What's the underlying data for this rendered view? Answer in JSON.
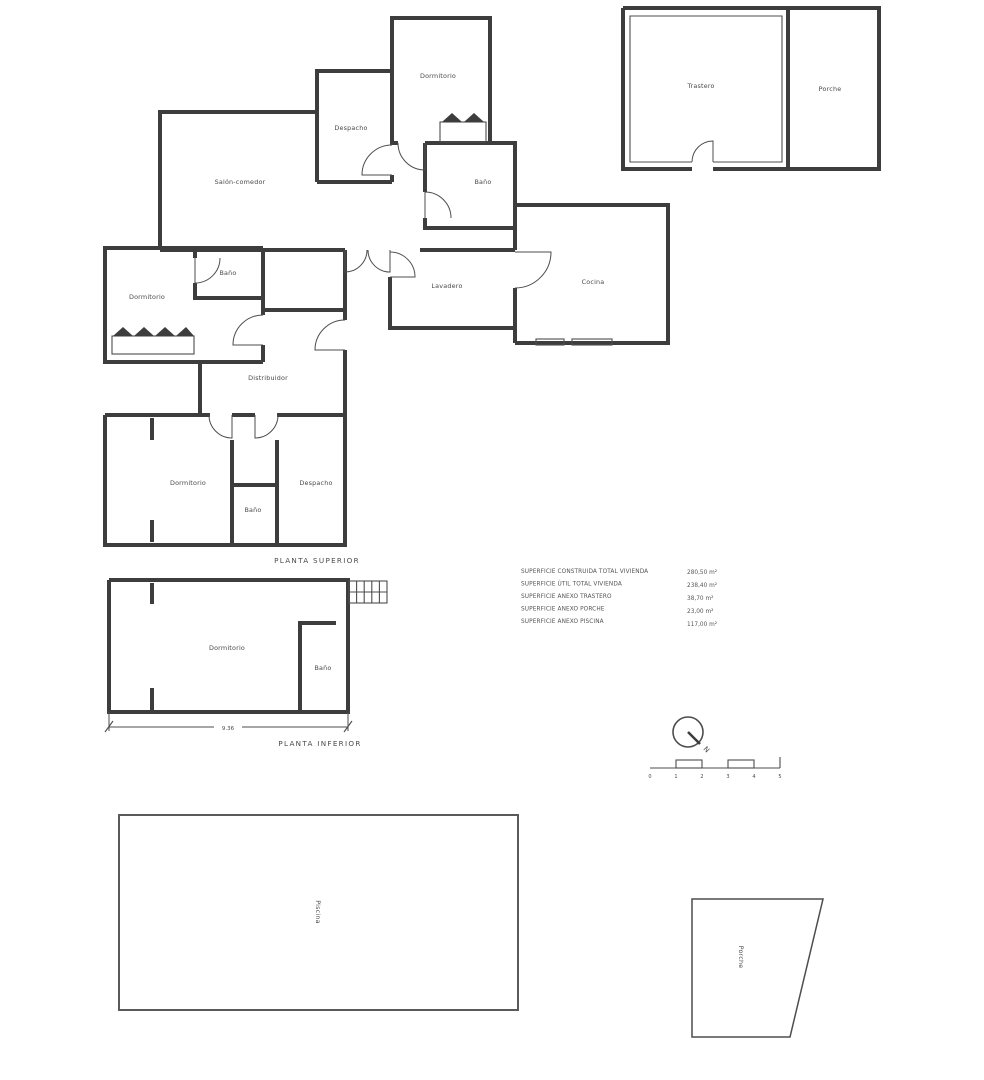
{
  "upper_plan": {
    "title": "PLANTA SUPERIOR",
    "rooms": {
      "dormitorio_top": "Dormitorio",
      "despacho_top": "Despacho",
      "salon_comedor": "Salón-comedor",
      "bano_top": "Baño",
      "cocina": "Cocina",
      "lavadero": "Lavadero",
      "dormitorio_left": "Dormitorio",
      "bano_left": "Baño",
      "distribuidor": "Distribuidor",
      "dormitorio_bottom": "Dormitorio",
      "bano_bottom": "Baño",
      "despacho_bottom": "Despacho"
    }
  },
  "annex_plan": {
    "trastero": "Trastero",
    "porche": "Porche"
  },
  "lower_plan": {
    "title": "PLANTA INFERIOR",
    "dormitorio": "Dormitorio",
    "bano": "Baño",
    "dimension_width": "9.36"
  },
  "areas_table": {
    "rows": [
      {
        "label": "SUPERFICIE CONSTRUIDA TOTAL VIVIENDA",
        "value": "280,50 m²"
      },
      {
        "label": "SUPERFICIE ÚTIL TOTAL VIVIENDA",
        "value": "238,40 m²"
      },
      {
        "label": "SUPERFICIE ANEXO TRASTERO",
        "value": "38,70 m²"
      },
      {
        "label": "SUPERFICIE ANEXO PORCHE",
        "value": "23,00 m²"
      },
      {
        "label": "SUPERFICIE ANEXO PISCINA",
        "value": "117,00 m²"
      }
    ]
  },
  "compass": {
    "north": "N"
  },
  "scale_bar": {
    "ticks": [
      "0",
      "1",
      "2",
      "3",
      "4",
      "5"
    ]
  },
  "site_features": {
    "piscina": "Piscina",
    "porche": "Porche"
  }
}
